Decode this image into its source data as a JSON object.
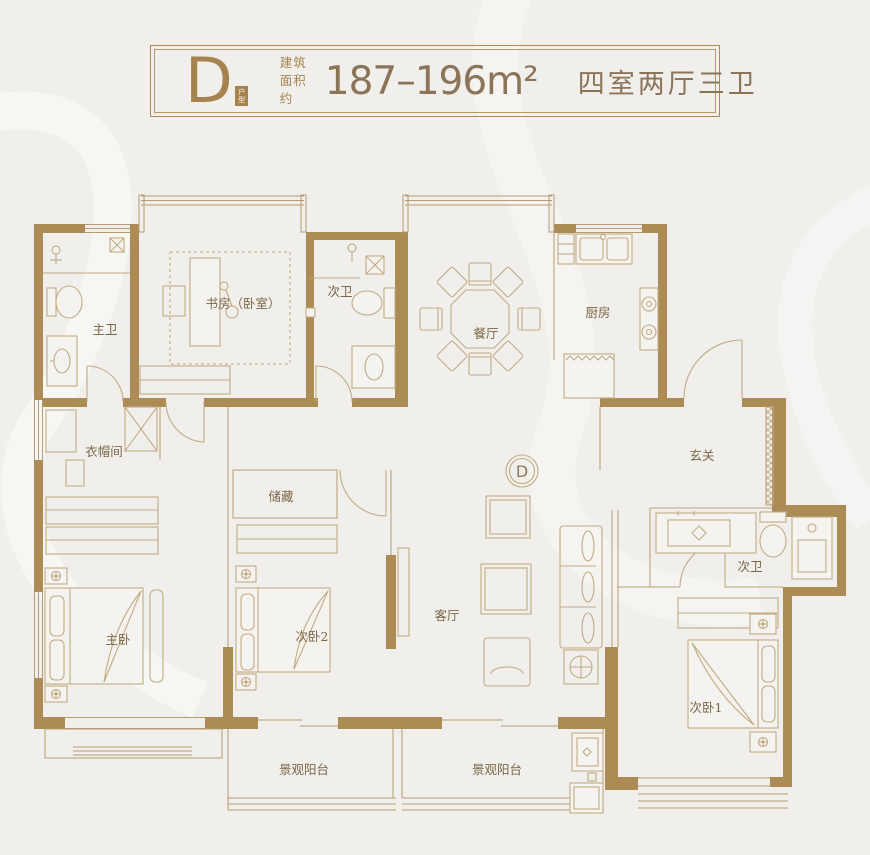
{
  "header": {
    "unit_letter": "D",
    "unit_badge": "户型",
    "area_prefix_line1": "建筑",
    "area_prefix_line2": "面积约",
    "area_value": "187–196m²",
    "layout_text": "四室两厅三卫",
    "accent_color": "#a5834e",
    "value_color": "#8c7458"
  },
  "floorplan": {
    "marker_letter": "D",
    "wall_color": "#ad8b55",
    "line_color": "#bda378",
    "label_color": "#7a6746",
    "rooms": {
      "master_bath": "主卫",
      "study": "书房（卧室）",
      "bath_top": "次卫",
      "dining": "餐厅",
      "kitchen": "厨房",
      "foyer": "玄关",
      "cloakroom": "衣帽间",
      "storage": "储藏",
      "master_bedroom": "主卧",
      "bedroom2": "次卧2",
      "living": "客厅",
      "bath_right": "次卫",
      "bedroom1": "次卧1",
      "balcony1": "景观阳台",
      "balcony2": "景观阳台"
    }
  }
}
